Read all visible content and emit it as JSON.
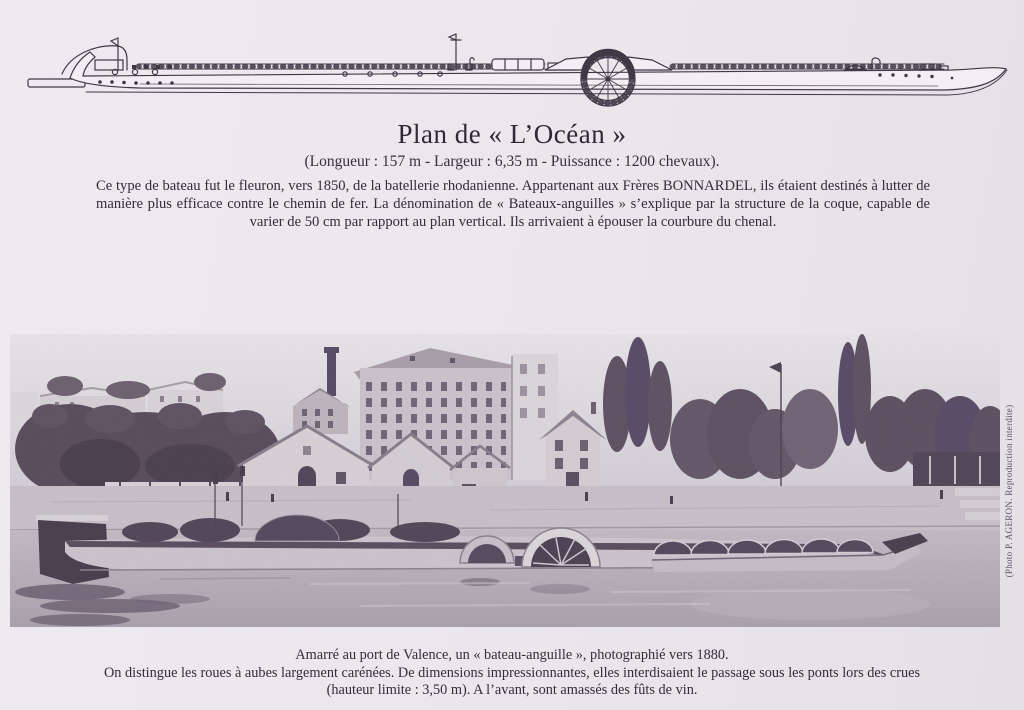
{
  "title": {
    "text": "Plan de « L’Océan »"
  },
  "subtitle": {
    "text": "(Longueur : 157 m - Largeur : 6,35 m - Puissance : 1200 chevaux)."
  },
  "intro": {
    "text": "Ce type de bateau fut le fleuron, vers 1850, de la batellerie rhodanienne. Appartenant aux Frères BONNARDEL, ils étaient destinés à lutter de manière plus efficace contre le chemin de fer. La dénomination de « Bateaux-anguilles » s’explique par la structure de la coque, capable de varier de 50 cm par rapport au plan vertical. Ils arrivaient à épouser la courbure du chenal."
  },
  "photo": {
    "credit": "(Photo P. AGERON. Reproduction interdite)",
    "palette": {
      "sky": "#e2dee4",
      "trees": "#574b5b",
      "walls": "#d7d1d6",
      "water": "#b2aab4",
      "dark_hull": "#473d4c",
      "ink": "#3f3947"
    }
  },
  "caption": {
    "line1": "Amarré au port de Valence, un « bateau-anguille », photographié vers 1880.",
    "line2": "On distingue les roues à aubes largement carénées. De dimensions impressionnantes, elles interdisaient le passage sous les ponts lors des crues (hauteur limite : 3,50 m). A l’avant, sont amassés des fûts de vin."
  }
}
